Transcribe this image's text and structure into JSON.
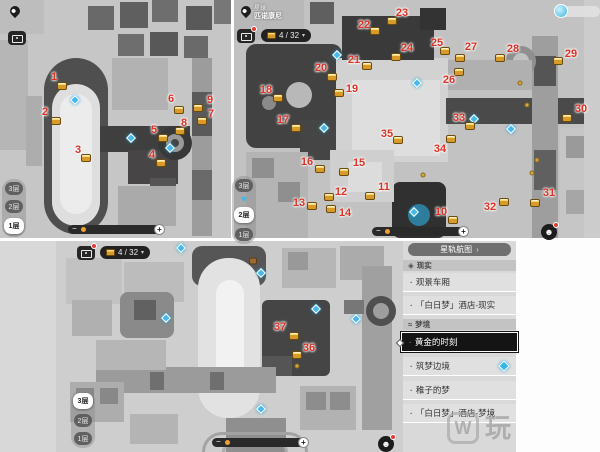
{
  "icons": {
    "bullet": "·",
    "caret_down": "▾",
    "chevron_right": "›",
    "minus": "−",
    "plus": "+",
    "face": "☻",
    "reality_diamond": "◈",
    "dream_wave": "≈"
  },
  "panel1": {
    "floors": [
      "3层",
      "2层",
      "1层"
    ],
    "active_floor": "1层",
    "markers": [
      {
        "n": "1",
        "x": 54,
        "y": 77,
        "cx": 62,
        "cy": 86
      },
      {
        "n": "2",
        "x": 45,
        "y": 112,
        "cx": 56,
        "cy": 121
      },
      {
        "n": "3",
        "x": 78,
        "y": 150,
        "cx": 86,
        "cy": 158
      },
      {
        "n": "4",
        "x": 152,
        "y": 155,
        "cx": 161,
        "cy": 163
      },
      {
        "n": "5",
        "x": 154,
        "y": 130,
        "cx": 163,
        "cy": 138
      },
      {
        "n": "6",
        "x": 171,
        "y": 99,
        "cx": 179,
        "cy": 110
      },
      {
        "n": "7",
        "x": 211,
        "y": 114,
        "cx": 202,
        "cy": 121
      },
      {
        "n": "8",
        "x": 184,
        "y": 123,
        "cx": 180,
        "cy": 131
      },
      {
        "n": "9",
        "x": 210,
        "y": 100,
        "cx": 198,
        "cy": 108
      }
    ],
    "teleports": [
      {
        "x": 75,
        "y": 100
      },
      {
        "x": 131,
        "y": 138
      },
      {
        "x": 170,
        "y": 148
      }
    ],
    "minor_icons": []
  },
  "panel2": {
    "location_label": "星球",
    "location_name": "匹诺康尼",
    "counter": "4 / 32",
    "floors": [
      "3层",
      "2层",
      "1层"
    ],
    "active_floor": "2层",
    "markers": [
      {
        "n": "10",
        "x": 441,
        "y": 212,
        "cx": 453,
        "cy": 220
      },
      {
        "n": "11",
        "x": 384,
        "y": 187,
        "cx": 370,
        "cy": 196
      },
      {
        "n": "12",
        "x": 341,
        "y": 192,
        "cx": 329,
        "cy": 197
      },
      {
        "n": "13",
        "x": 299,
        "y": 203,
        "cx": 312,
        "cy": 206
      },
      {
        "n": "14",
        "x": 345,
        "y": 213,
        "cx": 331,
        "cy": 209
      },
      {
        "n": "15",
        "x": 359,
        "y": 163,
        "cx": 344,
        "cy": 172
      },
      {
        "n": "16",
        "x": 307,
        "y": 162,
        "cx": 320,
        "cy": 169
      },
      {
        "n": "17",
        "x": 283,
        "y": 120,
        "cx": 296,
        "cy": 128
      },
      {
        "n": "18",
        "x": 266,
        "y": 90,
        "cx": 278,
        "cy": 98
      },
      {
        "n": "19",
        "x": 352,
        "y": 89,
        "cx": 339,
        "cy": 93
      },
      {
        "n": "20",
        "x": 321,
        "y": 68,
        "cx": 332,
        "cy": 77
      },
      {
        "n": "21",
        "x": 354,
        "y": 60,
        "cx": 367,
        "cy": 66
      },
      {
        "n": "22",
        "x": 364,
        "y": 25,
        "cx": 375,
        "cy": 31
      },
      {
        "n": "23",
        "x": 402,
        "y": 13,
        "cx": 392,
        "cy": 21
      },
      {
        "n": "24",
        "x": 407,
        "y": 48,
        "cx": 396,
        "cy": 57
      },
      {
        "n": "25",
        "x": 437,
        "y": 43,
        "cx": 445,
        "cy": 51
      },
      {
        "n": "26",
        "x": 449,
        "y": 80,
        "cx": 459,
        "cy": 72
      },
      {
        "n": "27",
        "x": 471,
        "y": 47,
        "cx": 460,
        "cy": 58
      },
      {
        "n": "28",
        "x": 513,
        "y": 49,
        "cx": 500,
        "cy": 58
      },
      {
        "n": "29",
        "x": 571,
        "y": 54,
        "cx": 558,
        "cy": 61
      },
      {
        "n": "30",
        "x": 581,
        "y": 109,
        "cx": 567,
        "cy": 118
      },
      {
        "n": "31",
        "x": 549,
        "y": 193,
        "cx": 535,
        "cy": 203
      },
      {
        "n": "32",
        "x": 490,
        "y": 207,
        "cx": 504,
        "cy": 202
      },
      {
        "n": "33",
        "x": 459,
        "y": 118,
        "cx": 470,
        "cy": 126
      },
      {
        "n": "34",
        "x": 440,
        "y": 149,
        "cx": 451,
        "cy": 139
      },
      {
        "n": "35",
        "x": 387,
        "y": 134,
        "cx": 398,
        "cy": 140
      }
    ],
    "teleports": [
      {
        "x": 337,
        "y": 55
      },
      {
        "x": 324,
        "y": 128
      },
      {
        "x": 417,
        "y": 83
      },
      {
        "x": 474,
        "y": 119
      },
      {
        "x": 511,
        "y": 129
      },
      {
        "x": 414,
        "y": 212
      }
    ],
    "minor_icons": [
      {
        "x": 520,
        "y": 83
      },
      {
        "x": 527,
        "y": 105
      },
      {
        "x": 537,
        "y": 160
      },
      {
        "x": 532,
        "y": 173
      },
      {
        "x": 423,
        "y": 175
      }
    ]
  },
  "panel3": {
    "counter": "4 / 32",
    "floors": [
      "3层",
      "2层",
      "1层"
    ],
    "active_floor": "3层",
    "markers": [
      {
        "n": "37",
        "x": 280,
        "y": 327,
        "cx": 294,
        "cy": 336
      },
      {
        "n": "36",
        "x": 309,
        "y": 348,
        "cx": 297,
        "cy": 355
      }
    ],
    "teleports": [
      {
        "x": 181,
        "y": 248
      },
      {
        "x": 261,
        "y": 273
      },
      {
        "x": 316,
        "y": 309
      },
      {
        "x": 356,
        "y": 319
      },
      {
        "x": 166,
        "y": 318
      },
      {
        "x": 261,
        "y": 409
      }
    ],
    "minor_icons": [
      {
        "x": 297,
        "y": 366
      }
    ]
  },
  "sidebar": {
    "header": "星轨航图",
    "sections": [
      {
        "title": "现实",
        "items": [
          {
            "label": "观景车厢"
          },
          {
            "label": "「白日梦」酒店-现实"
          }
        ]
      },
      {
        "title": "梦境",
        "items": [
          {
            "label": "黄金的时刻",
            "selected": true
          },
          {
            "label": "筑梦边境",
            "has_locator": true
          },
          {
            "label": "稚子的梦"
          },
          {
            "label": "「白日梦」酒店-梦境"
          }
        ]
      }
    ]
  },
  "watermark": {
    "logo": "W",
    "text": "玩"
  }
}
